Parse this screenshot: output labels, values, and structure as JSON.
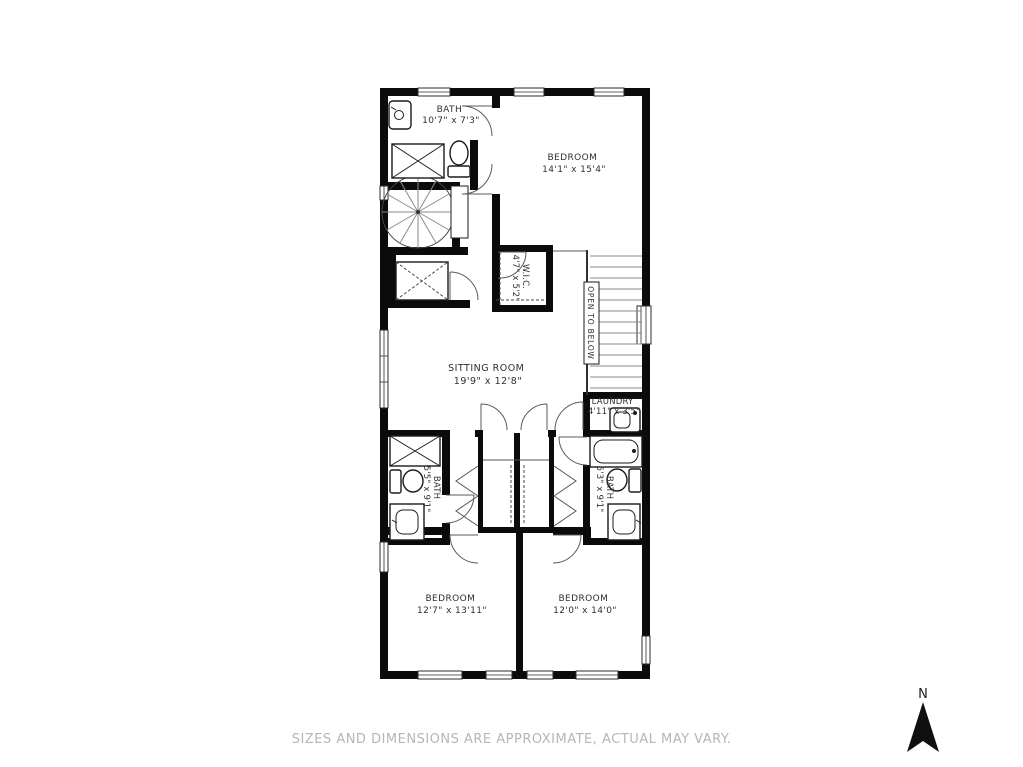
{
  "page": {
    "background": "#ffffff"
  },
  "colors": {
    "walls": "#0b0b0b",
    "labels": "#2f2f2f",
    "disclaimer_text": "#b6b6b6",
    "stair_treads": "#8a8a8a"
  },
  "floorplan": {
    "rooms": {
      "bath_upper": {
        "name": "BATH",
        "dims": "10'7\" x 7'3\""
      },
      "bedroom_upper": {
        "name": "BEDROOM",
        "dims": "14'1\" x 15'4\""
      },
      "wic": {
        "name": "W.I.C.",
        "dims": "4'7\" x 5'2\""
      },
      "open_below": {
        "name": "OPEN TO BELOW"
      },
      "sitting_room": {
        "name": "SITTING ROOM",
        "dims": "19'9\" x 12'8\""
      },
      "laundry": {
        "name": "LAUNDRY",
        "dims": "4'11\" x 3'5\""
      },
      "bath_left": {
        "name": "BATH",
        "dims": "5'5\" x 9'1\""
      },
      "bath_right": {
        "name": "BATH",
        "dims": "5'3\" x 9'1\""
      },
      "bedroom_left": {
        "name": "BEDROOM",
        "dims": "12'7\" x 13'11\""
      },
      "bedroom_right": {
        "name": "BEDROOM",
        "dims": "12'0\" x 14'0\""
      }
    }
  },
  "compass": {
    "label": "N"
  },
  "footer": {
    "disclaimer": "SIZES AND DIMENSIONS ARE APPROXIMATE, ACTUAL MAY VARY."
  }
}
